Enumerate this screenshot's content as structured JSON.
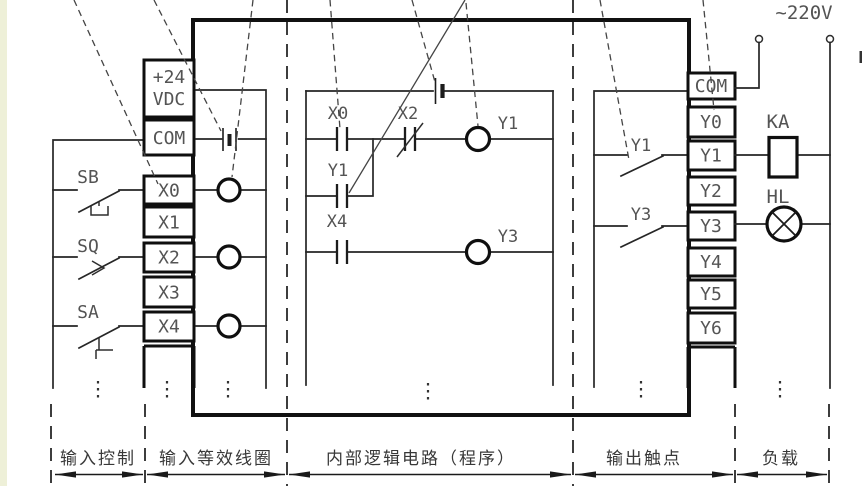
{
  "diagram": {
    "ac_supply": "~220V",
    "left_strip": {
      "power_line1": "+24",
      "power_line2": "VDC",
      "com": "COM",
      "inputs": [
        "X0",
        "X1",
        "X2",
        "X3",
        "X4"
      ]
    },
    "right_strip": {
      "com": "COM",
      "outputs": [
        "Y0",
        "Y1",
        "Y2",
        "Y3",
        "Y4",
        "Y5",
        "Y6"
      ]
    },
    "input_devices": [
      "SB",
      "SQ",
      "SA"
    ],
    "ladder": {
      "rung1_contact_no": "X0",
      "rung1_contact_nc": "X2",
      "rung1_coil": "Y1",
      "parallel_contact": "Y1",
      "rung2_contact_no": "X4",
      "rung2_coil": "Y3"
    },
    "output_contacts": [
      "Y1",
      "Y3"
    ],
    "loads": [
      {
        "label": "KA"
      },
      {
        "label": "HL"
      }
    ],
    "sections": [
      "输入控制",
      "输入等效线圈",
      "内部逻辑电路（程序）",
      "输出触点",
      "负载"
    ]
  }
}
